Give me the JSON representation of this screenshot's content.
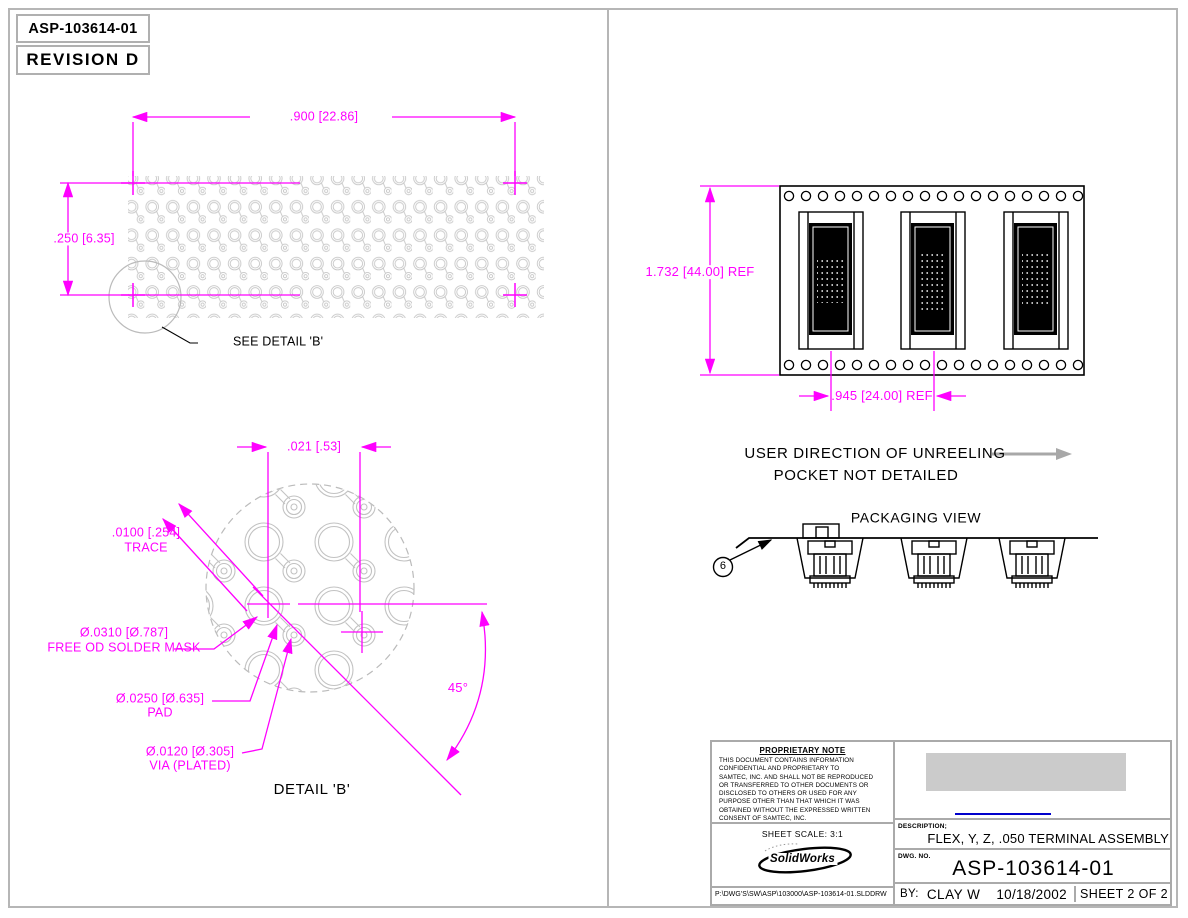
{
  "header": {
    "part_number": "ASP-103614-01",
    "revision": "REVISION  D"
  },
  "array_view": {
    "dim_width": ".900 [22.86]",
    "dim_height": ".250 [6.35]",
    "see_detail": "SEE DETAIL 'B'"
  },
  "detail_b": {
    "dim_pitch": ".021 [.53]",
    "trace_dim": ".0100 [.254]",
    "trace_label": "TRACE",
    "solder_mask_dim": "Ø.0310 [Ø.787]",
    "solder_mask_label": "FREE OD SOLDER MASK",
    "pad_dim": "Ø.0250 [Ø.635]",
    "pad_label": "PAD",
    "via_dim": "Ø.0120 [Ø.305]",
    "via_label": "VIA (PLATED)",
    "angle": "45°",
    "title": "DETAIL 'B'"
  },
  "tape_view": {
    "dim_height": "1.732 [44.00]  REF",
    "dim_pitch": ".945 [24.00]  REF",
    "unreeling": "USER DIRECTION OF UNREELING",
    "pocket_note": "POCKET NOT DETAILED",
    "packaging_title": "PACKAGING VIEW",
    "balloon": "6"
  },
  "title_block": {
    "proprietary_title": "PROPRIETARY NOTE",
    "proprietary_lines": [
      "THIS DOCUMENT CONTAINS INFORMATION",
      "CONFIDENTIAL AND PROPRIETARY TO",
      "SAMTEC, INC. AND SHALL NOT BE REPRODUCED",
      "OR TRANSFERRED TO OTHER DOCUMENTS OR",
      "DISCLOSED TO OTHERS OR USED FOR ANY",
      "PURPOSE OTHER THAN THAT WHICH IT WAS",
      "OBTAINED WITHOUT THE EXPRESSED WRITTEN",
      "CONSENT OF SAMTEC, INC."
    ],
    "sheet_scale": "SHEET SCALE: 3:1",
    "logo_text": "SolidWorks",
    "file_path": "P:\\DWG'S\\SW\\ASP\\103000\\ASP-103614-01.SLDDRW",
    "description_label": "DESCRIPTION;",
    "description": "FLEX, Y, Z, .050 TERMINAL ASSEMBLY",
    "dwg_no_label": "DWG. NO.",
    "dwg_no": "ASP-103614-01",
    "by_label": "BY:",
    "by_name": "CLAY W",
    "date": "10/18/2002",
    "sheet": "SHEET 2 OF 2"
  },
  "colors": {
    "dimension_magenta": "#ff00ff",
    "pattern_gray": "#c6c6c6",
    "border_gray": "#b6b6b6",
    "redaction_gray": "#cbcbcb",
    "link_blue": "#0000cc"
  }
}
